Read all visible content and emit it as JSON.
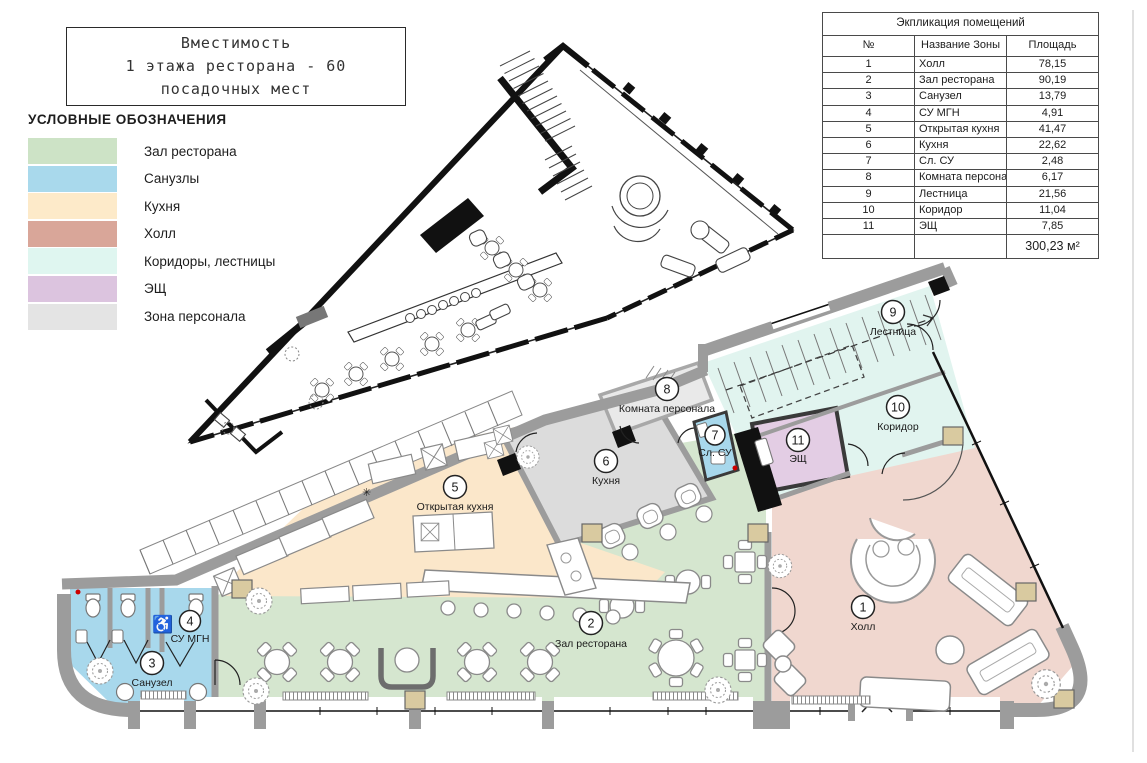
{
  "title_box": {
    "lines": [
      "Вместимость",
      "1 этажа ресторана - 60",
      "посадочных мест"
    ]
  },
  "legend": {
    "title": "УСЛОВНЫЕ ОБОЗНАЧЕНИЯ",
    "items": [
      {
        "label": "Зал ресторана",
        "color": "#cde3c6"
      },
      {
        "label": "Санузлы",
        "color": "#a9d9ec"
      },
      {
        "label": "Кухня",
        "color": "#fdeac9"
      },
      {
        "label": "Холл",
        "color": "#d9a699"
      },
      {
        "label": "Коридоры, лестницы",
        "color": "#dff6f0"
      },
      {
        "label": "ЭЩ",
        "color": "#dcc4df"
      },
      {
        "label": "Зона персонала",
        "color": "#e4e4e4"
      }
    ]
  },
  "table": {
    "title": "Экпликация помещений",
    "headers": [
      "№",
      "Название Зоны",
      "Площадь"
    ],
    "rows": [
      [
        "1",
        "Холл",
        "78,15"
      ],
      [
        "2",
        "Зал ресторана",
        "90,19"
      ],
      [
        "3",
        "Санузел",
        "13,79"
      ],
      [
        "4",
        "СУ МГН",
        "4,91"
      ],
      [
        "5",
        "Открытая кухня",
        "41,47"
      ],
      [
        "6",
        "Кухня",
        "22,62"
      ],
      [
        "7",
        "Сл. СУ",
        "2,48"
      ],
      [
        "8",
        "Комната персонала",
        "6,17"
      ],
      [
        "9",
        "Лестница",
        "21,56"
      ],
      [
        "10",
        "Коридор",
        "11,04"
      ],
      [
        "11",
        "ЭЩ",
        "7,85"
      ]
    ],
    "total": "300,23 м²"
  },
  "plan": {
    "rooms": [
      {
        "num": "1",
        "name": "Холл"
      },
      {
        "num": "2",
        "name": "Зал ресторана"
      },
      {
        "num": "3",
        "name": "Санузел"
      },
      {
        "num": "4",
        "name": "СУ МГН"
      },
      {
        "num": "5",
        "name": "Открытая кухня"
      },
      {
        "num": "6",
        "name": "Кухня"
      },
      {
        "num": "7",
        "name": "Сл. СУ"
      },
      {
        "num": "8",
        "name": "Комната персонала"
      },
      {
        "num": "9",
        "name": "Лестница"
      },
      {
        "num": "10",
        "name": "Коридор"
      },
      {
        "num": "11",
        "name": "ЭЩ"
      }
    ]
  },
  "colors": {
    "hall": "#f0d7cf",
    "restaurant": "#d5e6cf",
    "open_kitchen": "#fbe7ca",
    "wc": "#a8d8ec",
    "corridor": "#e1f4ef",
    "esh": "#e3cde4",
    "kitchen": "#dcdcdc",
    "staff": "#e9e9e9",
    "wall": "#9c9c9c",
    "column": "#d9caa0",
    "black_wall": "#111111"
  }
}
